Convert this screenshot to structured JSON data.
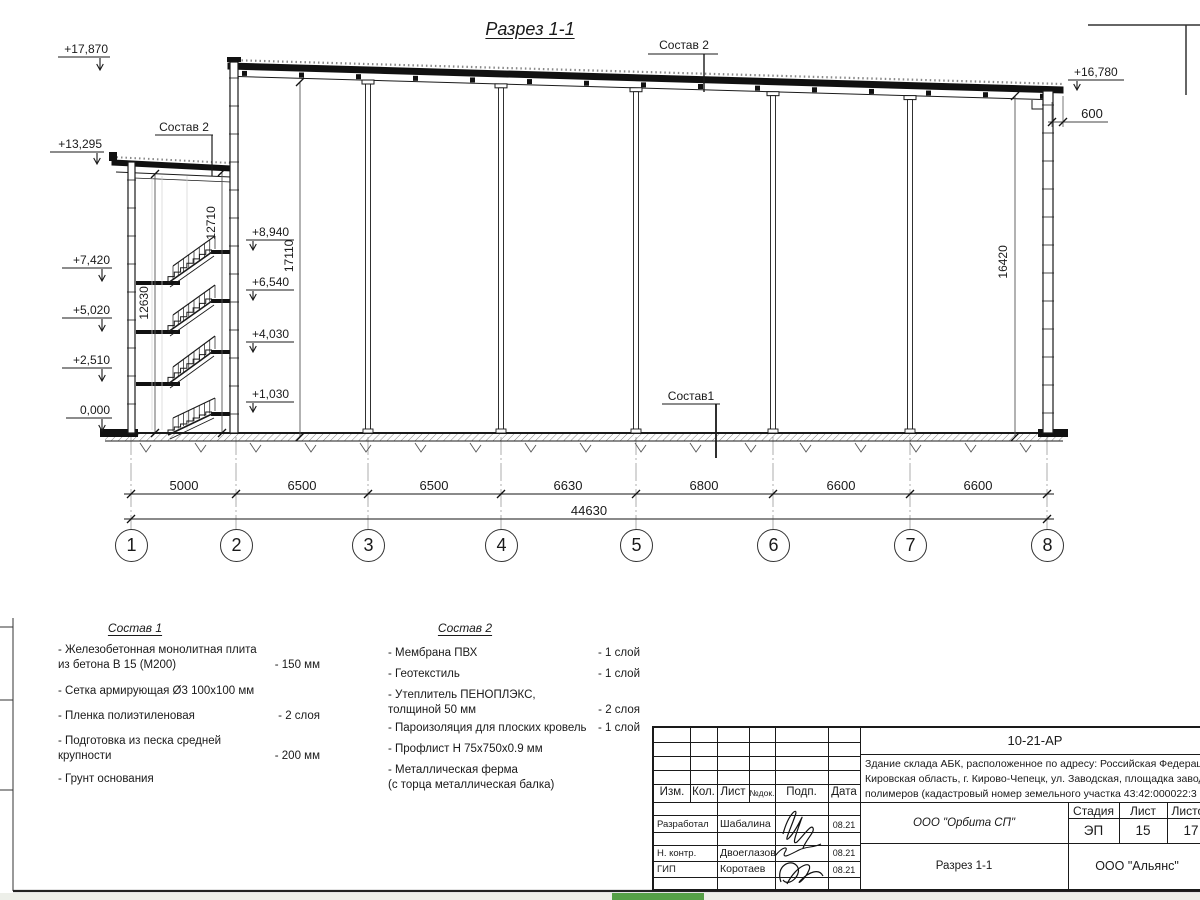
{
  "section": {
    "title": "Разрез 1-1",
    "labels": {
      "sostav2_roof": "Состав 2",
      "sostav2_stair": "Состав 2",
      "sostav1_floor": "Состав1"
    },
    "elev": {
      "e17870": "+17,870",
      "e13295": "+13,295",
      "e7420": "+7,420",
      "e5020": "+5,020",
      "e2510": "+2,510",
      "e0000": "0,000",
      "e8940": "+8,940",
      "e6540": "+6,540",
      "e4030": "+4,030",
      "e1030": "+1,030",
      "e16780": "+16,780"
    },
    "vdims": {
      "d12710": "12710",
      "d12630": "12630",
      "d17110": "17110",
      "d16420": "16420"
    },
    "d600": "600",
    "dims": [
      "5000",
      "6500",
      "6500",
      "6630",
      "6800",
      "6600",
      "6600"
    ],
    "total": "44630",
    "axes": [
      "1",
      "2",
      "3",
      "4",
      "5",
      "6",
      "7",
      "8"
    ]
  },
  "materials1": {
    "title": "Состав 1",
    "rows": [
      {
        "name": "- Железобетонная  монолитная плита\nиз бетона В 15 (М200)",
        "val": "- 150 мм"
      },
      {
        "name": "- Сетка армирующая Ø3 100х100 мм",
        "val": ""
      },
      {
        "name": "- Пленка полиэтиленовая",
        "val": "-  2 слоя"
      },
      {
        "name": "- Подготовка из песка средней\nкрупности",
        "val": "- 200 мм"
      },
      {
        "name": "- Грунт основания",
        "val": ""
      }
    ]
  },
  "materials2": {
    "title": "Состав 2",
    "rows": [
      {
        "name": "- Мембрана ПВХ",
        "val": "- 1 слой"
      },
      {
        "name": "- Геотекстиль",
        "val": "- 1 слой"
      },
      {
        "name": "- Утеплитель ПЕНОПЛЭКС,\nтолщиной 50 мм",
        "val": "- 2 слоя"
      },
      {
        "name": "- Пароизоляция для плоских кровель",
        "val": "- 1 слой"
      },
      {
        "name": "- Профлист Н 75х750х0.9 мм",
        "val": ""
      },
      {
        "name": "- Металлическая ферма\n(с торца металлическая балка)",
        "val": ""
      }
    ]
  },
  "stamp": {
    "doc_number": "10-21-АР",
    "description": "Здание склада АБК, расположенное по адресу: Российская Федерация,\nКировская область, г. Кирово-Чепецк, ул. Заводская, площадка завода\nполимеров (кадастровый номер земельного участка 43:42:000022:3",
    "cols": {
      "izm": "Изм.",
      "kol": "Кол.",
      "list": "Лист",
      "ndok": "№док.",
      "podp": "Подп.",
      "data": "Дата"
    },
    "rows": [
      {
        "role": "Разработал",
        "name": "Шабалина",
        "date": "08.21"
      },
      {
        "role": "Н. контр.",
        "name": "Двоеглазов",
        "date": "08.21"
      },
      {
        "role": "ГИП",
        "name": "Коротаев",
        "date": "08.21"
      }
    ],
    "org": "ООО \"Орбита СП\"",
    "stage_label": "Стадия",
    "sheet_label": "Лист",
    "sheets_label": "Листов",
    "stage": "ЭП",
    "sheet": "15",
    "sheets": "17",
    "drawing_name": "Разрез 1-1",
    "company": "ООО \"Альянс\""
  }
}
